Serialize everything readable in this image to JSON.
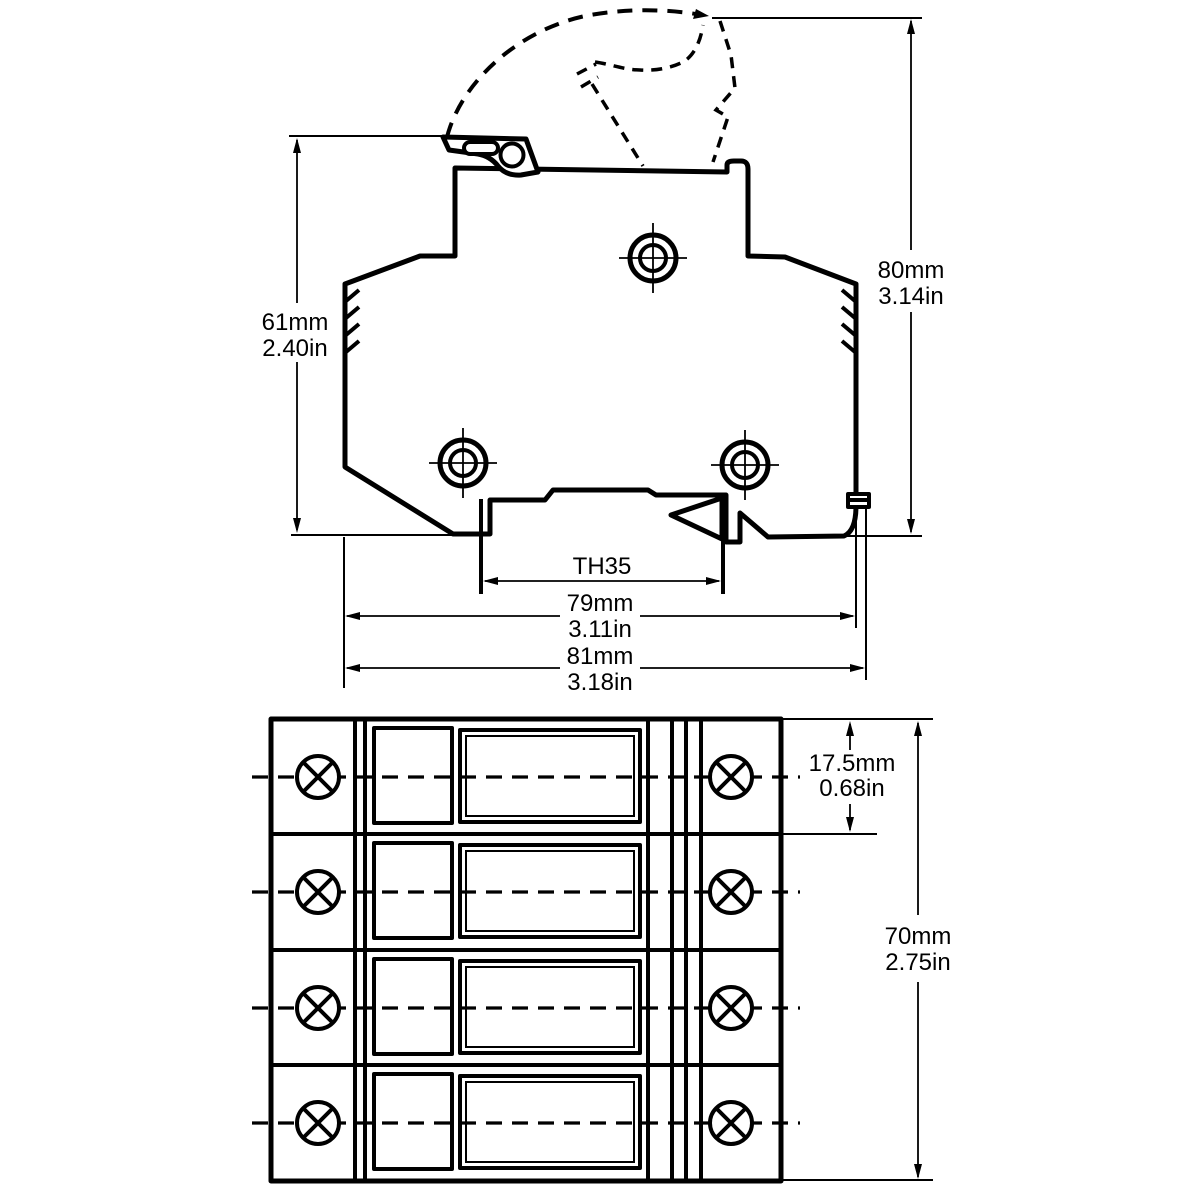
{
  "side_view": {
    "dims": {
      "height_body": {
        "mm": "61mm",
        "in": "2.40in"
      },
      "height_total": {
        "mm": "80mm",
        "in": "3.14in"
      },
      "rail_standard": "TH35",
      "width_inner": {
        "mm": "79mm",
        "in": "3.11in"
      },
      "width_outer": {
        "mm": "81mm",
        "in": "3.18in"
      }
    }
  },
  "front_view": {
    "dims": {
      "pole_pitch": {
        "mm": "17.5mm",
        "in": "0.68in"
      },
      "total_height": {
        "mm": "70mm",
        "in": "2.75in"
      }
    }
  },
  "colors": {
    "line": "#000000",
    "background": "#ffffff"
  }
}
